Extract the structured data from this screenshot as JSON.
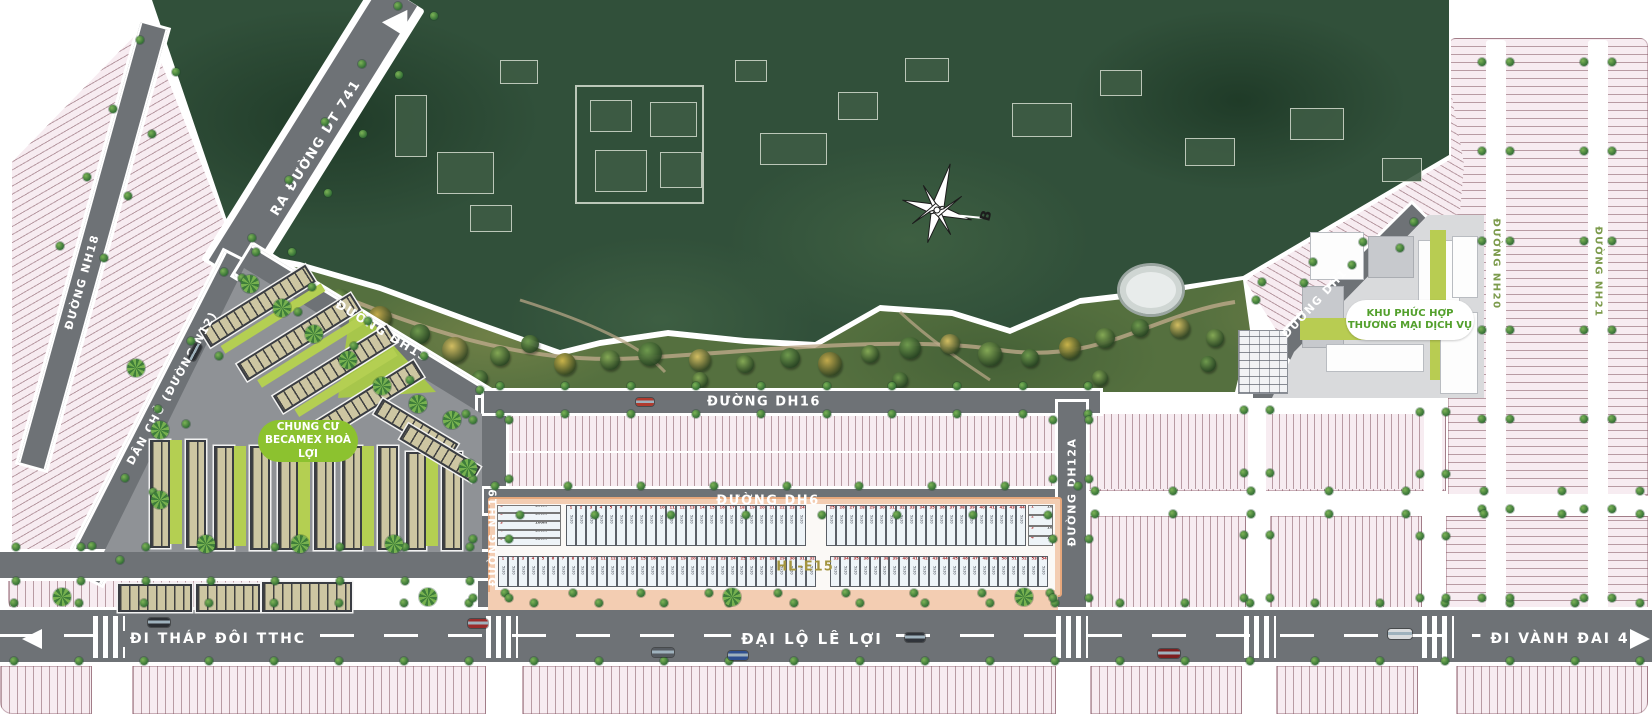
{
  "roads": {
    "dt741": "RA ĐƯỜNG DT 741",
    "dan_chu": "DÂN CHỦ (ĐƯỜNG N12)",
    "dh15": "ĐƯỜNG DH15",
    "dh16": "ĐƯỜNG DH16",
    "dh6": "ĐƯỜNG DH6",
    "dh17": "ĐƯỜNG DH17",
    "dh12a": "ĐƯỜNG DH12A",
    "nh18": "ĐƯỜNG NH18",
    "nh19": "ĐƯỜNG NH19",
    "nh20": "ĐƯỜNG NH20",
    "nh21": "ĐƯỜNG NH21",
    "le_loi": "ĐẠI LỘ LÊ LỢI",
    "dir_tthc": "ĐI THÁP ĐÔI TTHC",
    "dir_vanh_dai": "ĐI VÀNH ĐAI 4"
  },
  "badges": {
    "chung_cu_line1": "CHUNG CƯ",
    "chung_cu_line2": "BECAMEX HOÀ LỢI",
    "khu_line1": "KHU PHỨC HỢP",
    "khu_line2": "THƯƠNG MẠI DỊCH VỤ"
  },
  "block": {
    "label": "HL-E15",
    "lot_dims": "5x20",
    "upper_lot_counts": [
      24,
      20
    ],
    "lower_lot_counts": [
      32,
      22
    ],
    "left_table_rows": [
      "100m²",
      "100m²",
      "100m²",
      "100m²",
      "120m²"
    ],
    "right_table_rows": [
      "100m²",
      "102m²",
      "105m²",
      "110m²"
    ]
  },
  "compass": {
    "north_label": "B"
  },
  "colors": {
    "forest": "#31503a",
    "park": "#55703f",
    "lot_pink": "#f7ecf1",
    "road_gray": "#6e7276",
    "sidewalk_salmon": "#f3cdb2",
    "badge_green": "#8cc22f",
    "badge_text_green": "#53a02c",
    "lawn": "#b4cf52",
    "accent_red": "#b03030",
    "label_olive": "#a3953f"
  }
}
